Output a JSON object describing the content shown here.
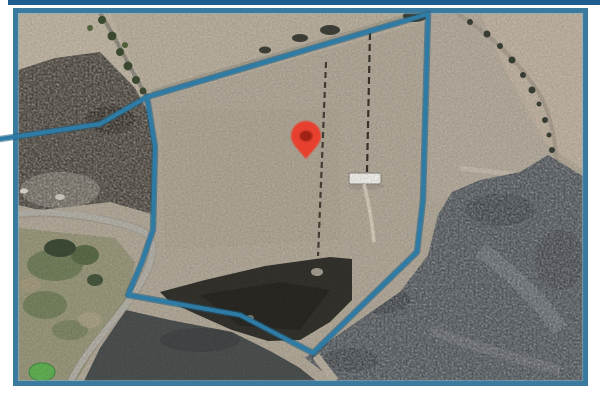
{
  "map": {
    "view_type": "satellite",
    "colors": {
      "frame": "#3a7a9e",
      "frame_top_strip": "#1d5e8e",
      "boundary": "#2e7ca6",
      "boundary_shadow": "#1f5d80",
      "pin_fill": "#e8402f",
      "pin_core": "#a22417",
      "field_tan": "#b4ab9b",
      "scrub_dark": "#565b60",
      "burn_dark": "#35332d",
      "burn_left": "#4e4840",
      "grass_green": "#9b9a7e",
      "pond_green": "#63b356",
      "road_gray": "#b5b2a9"
    },
    "parcel_boundary": {
      "points": "147,97 428,14 423,200 417,252 313,353 240,315 128,295 142,262 153,230 155,147"
    },
    "boundary_extension": {
      "points": "0,139 100,124 147,97"
    },
    "marker": {
      "transform": "translate(306,141)",
      "x": 306,
      "y": 141
    }
  }
}
